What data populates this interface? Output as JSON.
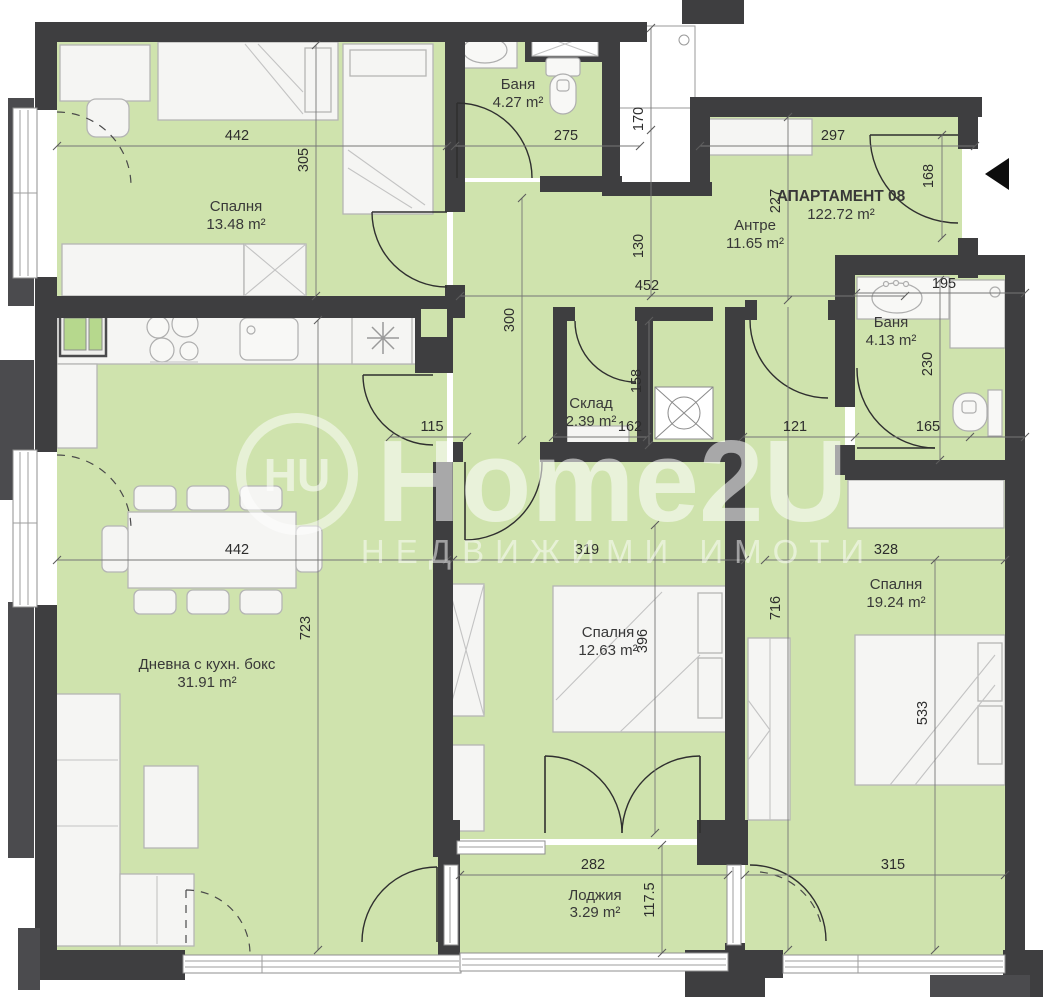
{
  "title": {
    "name": "АПАРТАМЕНТ 08",
    "area": "122.72 m²"
  },
  "rooms": {
    "bedroom1": {
      "name": "Спалня",
      "area": "13.48 m²"
    },
    "bath1": {
      "name": "Баня",
      "area": "4.27 m²"
    },
    "hall": {
      "name": "Антре",
      "area": "11.65 m²"
    },
    "bath2": {
      "name": "Баня",
      "area": "4.13 m²"
    },
    "storage": {
      "name": "Склад",
      "area": "2.39 m²"
    },
    "living": {
      "name": "Дневна с кухн. бокс",
      "area": "31.91 m²"
    },
    "bedroom2": {
      "name": "Спалня",
      "area": "12.63 m²"
    },
    "bedroom3": {
      "name": "Спалня",
      "area": "19.24 m²"
    },
    "loggia": {
      "name": "Лоджия",
      "area": "3.29 m²"
    }
  },
  "dims": {
    "bedroom1_width": "442",
    "bedroom1_depth": "305",
    "bath1_width": "275",
    "shaft_height": "170",
    "hall_right_width": "297",
    "hall_depth": "227",
    "entry_opening": "168",
    "hall_mid": "130",
    "hall_width": "452",
    "corridor_depth": "300",
    "bath2_top_width": "195",
    "bath2_depth": "230",
    "bath2_bottom_width": "165",
    "living_niche": "115",
    "storage_width": "162",
    "storage_depth": "158",
    "nook_width": "121",
    "living_width": "442",
    "bedroom2_width": "319",
    "bedroom3_width": "328",
    "living_depth": "723",
    "bedroom2_depth": "396",
    "bedroom3_depth": "716",
    "bed3_span": "533",
    "loggia_width": "282",
    "bedroom3_bottom_width": "315",
    "loggia_depth": "117.5"
  },
  "watermark": {
    "logo": "HU",
    "brand": "Home2U",
    "tagline": "НЕДВИЖИМИ ИМОТИ"
  },
  "colors": {
    "floor": "#cfe3ad",
    "wall": "#3e3e40",
    "accent_green": "#b6d88d"
  }
}
